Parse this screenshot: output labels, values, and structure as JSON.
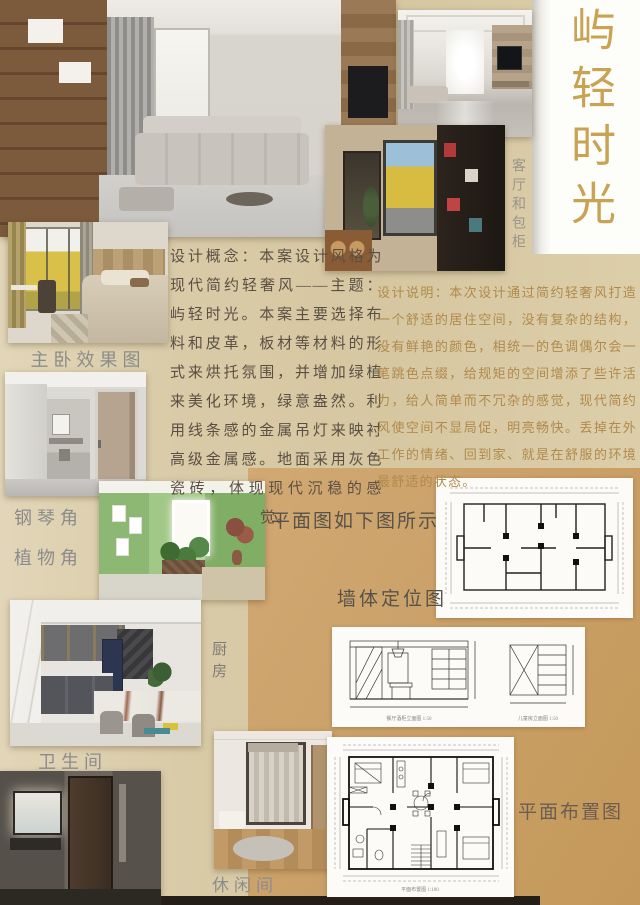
{
  "title": {
    "text": "屿轻时光"
  },
  "labels": {
    "living_cabinet": "客厅和包柜",
    "master_bedroom": "主卧效果图",
    "piano_corner": "钢琴角",
    "plant_corner": "植物角",
    "kitchen": "厨房",
    "bathroom": "卫生间",
    "leisure_room": "休闲间",
    "plan_note": "平面图如下图所示",
    "wall_plan": "墙体定位图",
    "furniture_plan": "平面布置图"
  },
  "texts": {
    "concept": "设计概念：本案设计风格为现代简约轻奢风——主题：屿轻时光。本案主要选择布料和皮革，板材等材料的形式来烘托氛围，并增加绿植来美化环境，绿意盎然。利用线条感的金属吊灯来映衬高级金属感。地面采用灰色瓷砖，体现现代沉稳的感觉。",
    "description": "设计说明：本次设计通过简约轻奢风打造一个舒适的居住空间，没有复杂的结构，没有鲜艳的颜色，相统一的色调偶尔会一笔跳色点缀，给规矩的空间增添了些许活力，给人简单而不冗杂的感觉，现代简约风使空间不显局促，明亮畅快。丢掉在外工作的情绪、回到家、就是在舒服的环境最舒适的状态。"
  },
  "plans": {
    "elevation_left_caption": "餐厅酒柜立面图 1:50",
    "elevation_right_caption": "儿童房立面图 1:50",
    "furniture_caption": "平面布置图 1:100"
  },
  "colors": {
    "title_gold": "#c9a254",
    "description_gold": "#b08a4b",
    "label_gray": "#8c8c8c",
    "background_beige": "#d8c9a5",
    "background_tan": "#cfa472"
  }
}
